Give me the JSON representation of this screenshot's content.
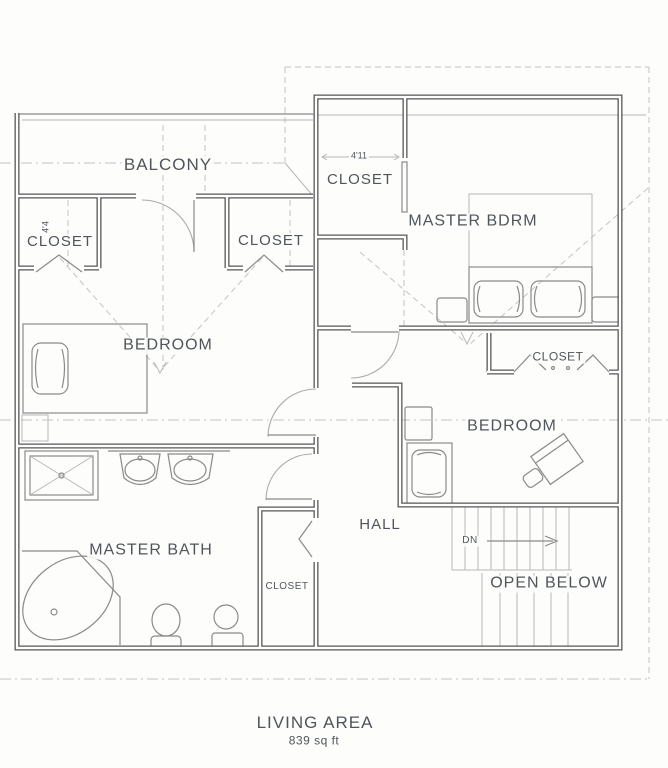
{
  "labels": {
    "balcony": "BALCONY",
    "bedroom_left": "BEDROOM",
    "bedroom_right": "BEDROOM",
    "master_bedroom": "MASTER BDRM",
    "master_bath": "MASTER BATH",
    "hall": "HALL",
    "open_below": "OPEN BELOW",
    "stairs_direction": "DN",
    "closet_left": "CLOSET",
    "closet_left2": "CLOSET",
    "closet_master": "CLOSET",
    "closet_bedroom": "CLOSET",
    "closet_hall": "CLOSET"
  },
  "dimensions": {
    "master_closet_width": "4'11",
    "left_closet_width": "4'4"
  },
  "summary": {
    "living_area_label": "LIVING AREA",
    "living_area_value": "839 sq ft"
  },
  "colors": {
    "wall": "#565656",
    "line": "#8a8a8a",
    "light_line": "#b8b8b8",
    "dashed": "#c4c4c4",
    "text": "#50555a",
    "background": "#fdfdfc"
  }
}
